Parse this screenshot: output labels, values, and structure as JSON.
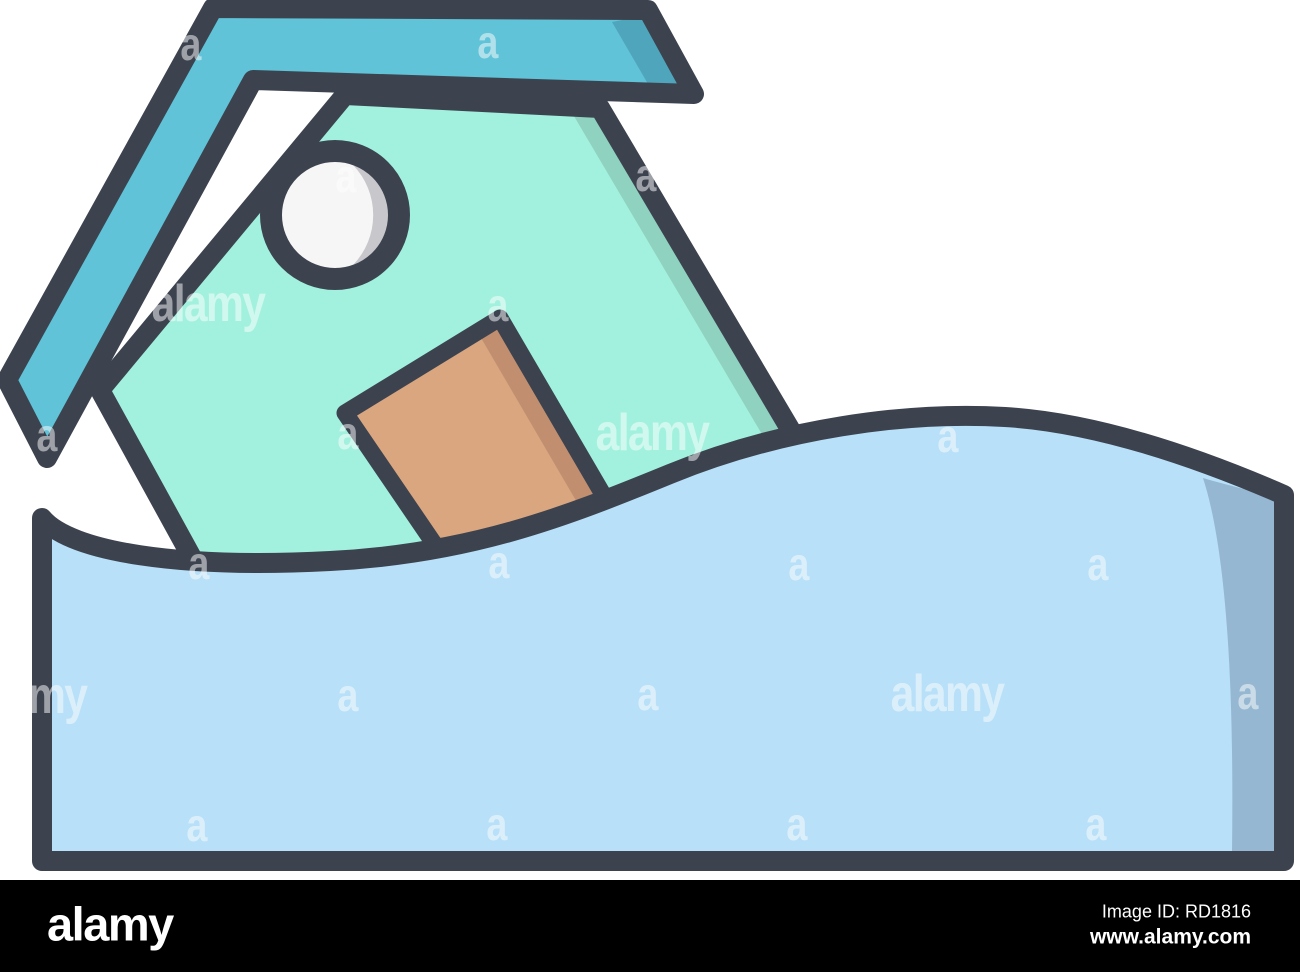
{
  "illustration": {
    "description": "Flood icon: tilted house with round window and door sinking into a wave of water, cartoon outline style",
    "colors": {
      "outline": "#3C434F",
      "roof": "#60C3D8",
      "roof_shadow": "#4FA6BC",
      "house": "#A2F1DE",
      "house_shadow": "#8FD2BF",
      "door": "#D9A67F",
      "door_shadow": "#C18F6F",
      "window": "#F6F6F7",
      "window_shadow": "#C8C8CC",
      "water": "#B8E0F8",
      "water_shadow": "#95B7D2",
      "watermark": "#FFFFFF",
      "bar": "#000000",
      "bartext": "#FFFFFF"
    }
  },
  "watermarks": {
    "items": [
      {
        "text": "a",
        "x": 190,
        "y": 46,
        "kind": "small"
      },
      {
        "text": "a",
        "x": 487,
        "y": 44,
        "kind": "small"
      },
      {
        "text": "a",
        "x": 345,
        "y": 178,
        "kind": "small"
      },
      {
        "text": "a",
        "x": 645,
        "y": 177,
        "kind": "small"
      },
      {
        "text": "alamy",
        "x": 208,
        "y": 306,
        "kind": "word"
      },
      {
        "text": "a",
        "x": 497,
        "y": 307,
        "kind": "small"
      },
      {
        "text": "a",
        "x": 46,
        "y": 437,
        "kind": "small"
      },
      {
        "text": "a",
        "x": 347,
        "y": 435,
        "kind": "small"
      },
      {
        "text": "alamy",
        "x": 652,
        "y": 435,
        "kind": "word"
      },
      {
        "text": "a",
        "x": 947,
        "y": 438,
        "kind": "small"
      },
      {
        "text": "a",
        "x": 198,
        "y": 565,
        "kind": "small"
      },
      {
        "text": "a",
        "x": 498,
        "y": 564,
        "kind": "small"
      },
      {
        "text": "a",
        "x": 798,
        "y": 566,
        "kind": "small"
      },
      {
        "text": "a",
        "x": 1097,
        "y": 566,
        "kind": "small"
      },
      {
        "text": "alamy",
        "x": 30,
        "y": 698,
        "kind": "word"
      },
      {
        "text": "a",
        "x": 347,
        "y": 697,
        "kind": "small"
      },
      {
        "text": "a",
        "x": 647,
        "y": 696,
        "kind": "small"
      },
      {
        "text": "alamy",
        "x": 947,
        "y": 696,
        "kind": "word"
      },
      {
        "text": "a",
        "x": 1247,
        "y": 695,
        "kind": "small"
      },
      {
        "text": "a",
        "x": 196,
        "y": 827,
        "kind": "small"
      },
      {
        "text": "a",
        "x": 496,
        "y": 826,
        "kind": "small"
      },
      {
        "text": "a",
        "x": 796,
        "y": 826,
        "kind": "small"
      },
      {
        "text": "a",
        "x": 1095,
        "y": 826,
        "kind": "small"
      }
    ]
  },
  "footer": {
    "logo_text": "alamy",
    "image_id_label": "Image ID: RD1816",
    "website_label": "www.alamy.com"
  }
}
